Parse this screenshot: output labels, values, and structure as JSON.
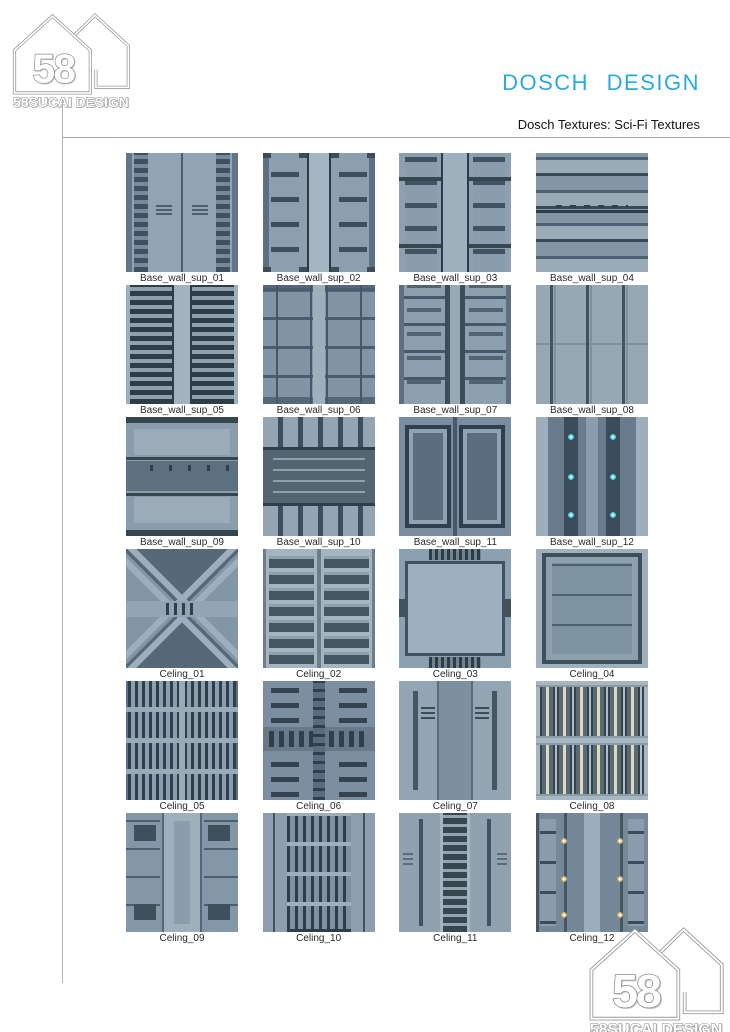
{
  "branding": {
    "logo_number": "58",
    "logo_name": "58SUCAI DESIGN"
  },
  "header": {
    "title": "DOSCH  DESIGN",
    "subtitle": "Dosch Textures: Sci-Fi Textures"
  },
  "colors": {
    "title_accent": "#29a9e1",
    "texture_base": "#8da0af",
    "texture_dark": "#46586a",
    "glow_cyan": "#49c6dd",
    "glow_warm": "#fff6da",
    "rule_gray": "#a8a8a8"
  },
  "textures": [
    {
      "label": "Base_wall_sup_01",
      "variant": "bws01"
    },
    {
      "label": "Base_wall_sup_02",
      "variant": "bws02"
    },
    {
      "label": "Base_wall_sup_03",
      "variant": "bws03"
    },
    {
      "label": "Base_wall_sup_04",
      "variant": "bws04"
    },
    {
      "label": "Base_wall_sup_05",
      "variant": "bws05"
    },
    {
      "label": "Base_wall_sup_06",
      "variant": "bws06"
    },
    {
      "label": "Base_wall_sup_07",
      "variant": "bws07"
    },
    {
      "label": "Base_wall_sup_08",
      "variant": "bws08"
    },
    {
      "label": "Base_wall_sup_09",
      "variant": "bws09"
    },
    {
      "label": "Base_wall_sup_10",
      "variant": "bws10"
    },
    {
      "label": "Base_wall_sup_11",
      "variant": "bws11"
    },
    {
      "label": "Base_wall_sup_12",
      "variant": "bws12"
    },
    {
      "label": "Celing_01",
      "variant": "c01"
    },
    {
      "label": "Celing_02",
      "variant": "c02"
    },
    {
      "label": "Celing_03",
      "variant": "c03"
    },
    {
      "label": "Celing_04",
      "variant": "c04"
    },
    {
      "label": "Celing_05",
      "variant": "c05"
    },
    {
      "label": "Celing_06",
      "variant": "c06"
    },
    {
      "label": "Celing_07",
      "variant": "c07"
    },
    {
      "label": "Celing_08",
      "variant": "c08"
    },
    {
      "label": "Celing_09",
      "variant": "c09"
    },
    {
      "label": "Celing_10",
      "variant": "c10"
    },
    {
      "label": "Celing_11",
      "variant": "c11"
    },
    {
      "label": "Celing_12",
      "variant": "c12"
    }
  ]
}
